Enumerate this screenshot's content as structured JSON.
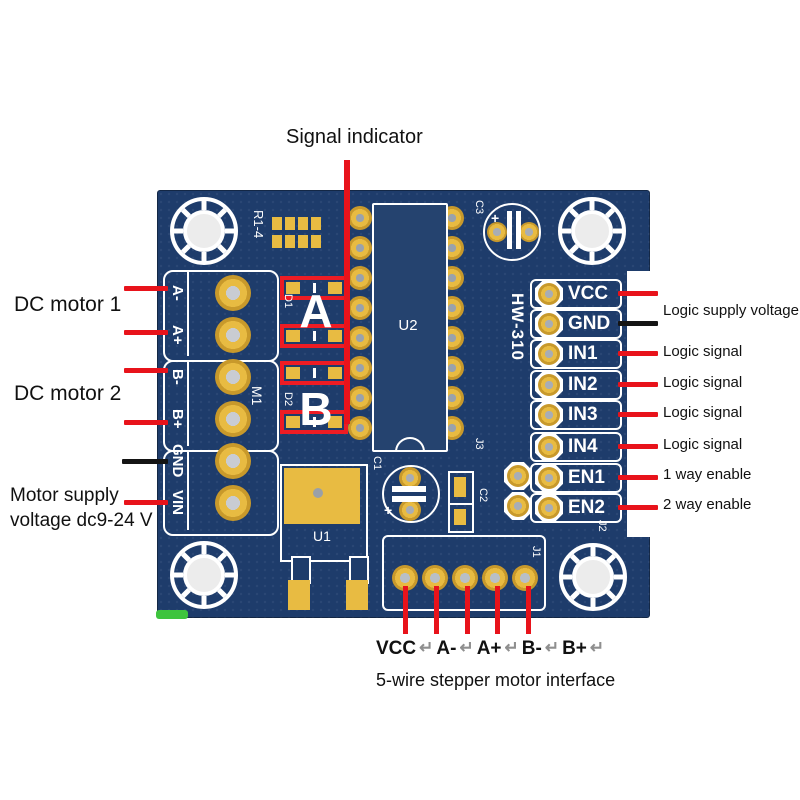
{
  "annotations": {
    "signal_indicator": "Signal indicator",
    "dc_motor_1": "DC motor 1",
    "dc_motor_2": "DC motor 2",
    "motor_supply_line1": "Motor supply",
    "motor_supply_line2": "voltage dc9-24 V"
  },
  "right_pins": [
    {
      "label": "VCC",
      "wire": "red",
      "note": "Logic supply voltage"
    },
    {
      "label": "GND",
      "wire": "black",
      "note": ""
    },
    {
      "label": "IN1",
      "wire": "red",
      "note": "Logic signal"
    },
    {
      "label": "IN2",
      "wire": "red",
      "note": "Logic signal"
    },
    {
      "label": "IN3",
      "wire": "red",
      "note": "Logic signal"
    },
    {
      "label": "IN4",
      "wire": "red",
      "note": "Logic signal"
    },
    {
      "label": "EN1",
      "wire": "red",
      "note": "1 way enable"
    },
    {
      "label": "EN2",
      "wire": "red",
      "note": "2 way enable"
    }
  ],
  "left_terminals": [
    "A-",
    "A+",
    "B-",
    "B+",
    "GND",
    "VIN"
  ],
  "silkscreen": {
    "r1_4": "R1-4",
    "u2": "U2",
    "hw_model": "HW-310",
    "m1": "M1",
    "u1": "U1",
    "c1": "C1",
    "c2": "C2",
    "c3": "C3",
    "j1": "J1",
    "j2": "J2",
    "j3": "J3",
    "d1": "D1",
    "d2": "D2",
    "led_a": "A",
    "led_b": "B",
    "plus": "+"
  },
  "bottom": {
    "pins": [
      "VCC",
      "A-",
      "A+",
      "B-",
      "B+"
    ],
    "separator": "↵",
    "caption": "5-wire stepper motor interface"
  },
  "colors": {
    "board_blue": "#1e3c6b",
    "silkscreen_white": "#ffffff",
    "pad_gold": "#e8bb42",
    "annotation_red": "#e8131b",
    "annotation_black": "#141414",
    "led_green": "#3ec43e"
  }
}
